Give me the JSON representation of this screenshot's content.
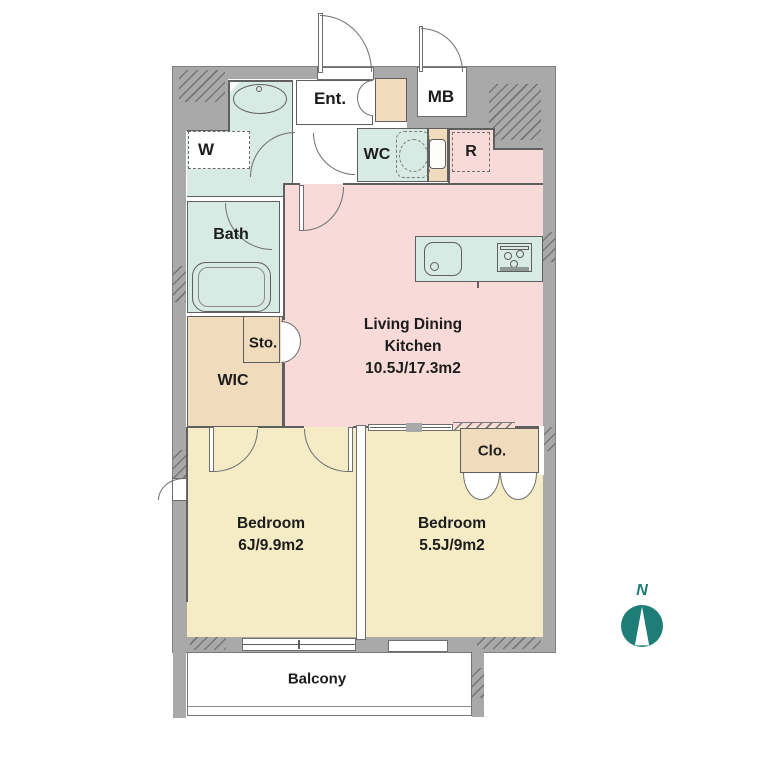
{
  "rooms": {
    "ldk": {
      "line1": "Living Dining",
      "line2": "Kitchen",
      "line3": "10.5J/17.3m2"
    },
    "bedroom1": {
      "line1": "Bedroom",
      "line2": "6J/9.9m2"
    },
    "bedroom2": {
      "line1": "Bedroom",
      "line2": "5.5J/9m2"
    },
    "bath": {
      "label": "Bath"
    },
    "wic": {
      "label": "WIC"
    },
    "sto": {
      "label": "Sto."
    },
    "clo": {
      "label": "Clo."
    },
    "wc": {
      "label": "WC"
    },
    "ent": {
      "label": "Ent."
    },
    "mb": {
      "label": "MB"
    },
    "balcony": {
      "label": "Balcony"
    },
    "washer_space": {
      "label": "W"
    },
    "fridge_space": {
      "label": "R"
    }
  },
  "compass": {
    "label": "N"
  },
  "colors": {
    "wall_gray": "#a9a9a9",
    "wet_area_mint": "#d7eae3",
    "ldk_pink": "#f8dbd8",
    "storage_beige": "#f0dcbd",
    "bedroom_yellow": "#f5ecc6",
    "outline": "#5f5f5f",
    "compass_teal": "#1f7d78"
  }
}
